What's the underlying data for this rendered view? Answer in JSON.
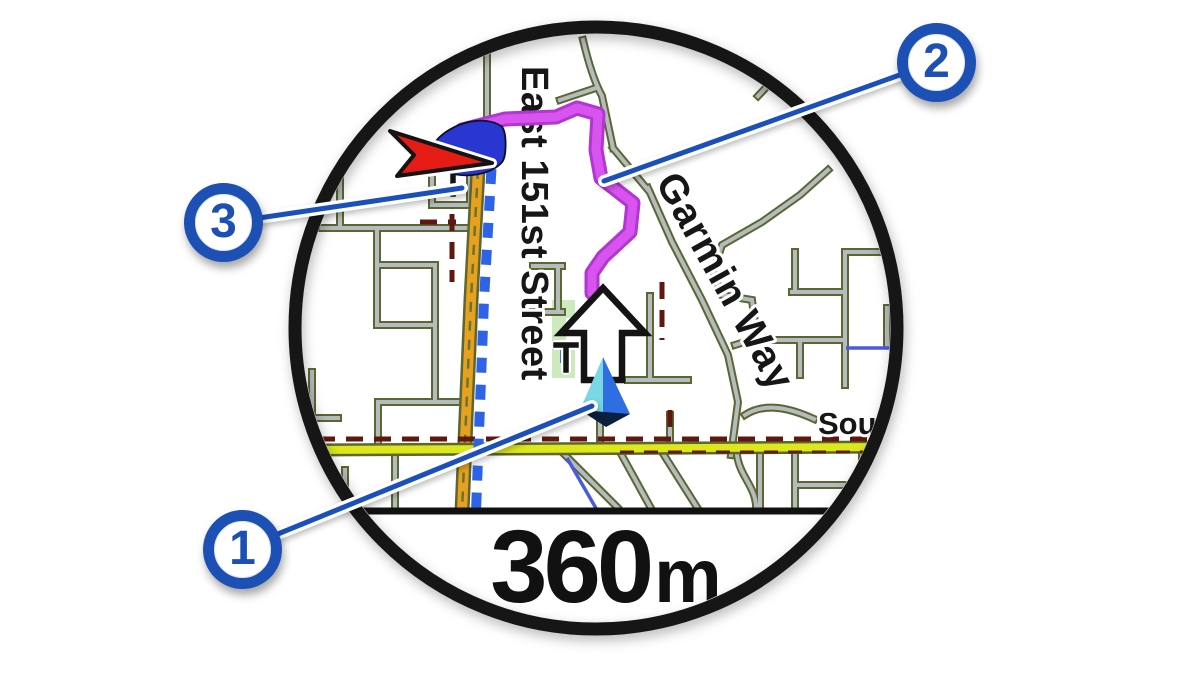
{
  "figure": {
    "title": "Watch map navigation screen",
    "scale": {
      "value": "360",
      "unit": "m"
    }
  },
  "map": {
    "labels": {
      "vertical_street": "East 151st Street",
      "diagonal_street": "Garmin Way",
      "partial_street": "Sout"
    }
  },
  "callouts": [
    {
      "number": "1",
      "points_to": "current-position-marker"
    },
    {
      "number": "2",
      "points_to": "route-line"
    },
    {
      "number": "3",
      "points_to": "destination-direction-indicator"
    }
  ],
  "icons": [
    "red-direction-pointer-icon",
    "blue-turn-arrow-icon",
    "white-navigation-arrow-icon",
    "position-triangle-icon"
  ],
  "colors": {
    "callout_blue": "#1c50b4",
    "leader_blue": "#1b50ba",
    "route_magenta": "#d954ef",
    "road_orange": "#e6a11f",
    "road_yellow": "#dde81a",
    "road_maroon": "#5f1710",
    "road_gray": "#b3bcbe",
    "road_casing_olive": "#5d6630",
    "dash_blue": "#2e63e8",
    "park_green": "#cdeabf",
    "stream_blue": "#4a5ae0",
    "marker_red": "#e51c16",
    "marker_blue": "#2936cf",
    "position_cyan": "#79d7e6",
    "position_blue": "#2e6ee2",
    "position_navy": "#0b1f3e",
    "bezel_black": "#161616"
  }
}
